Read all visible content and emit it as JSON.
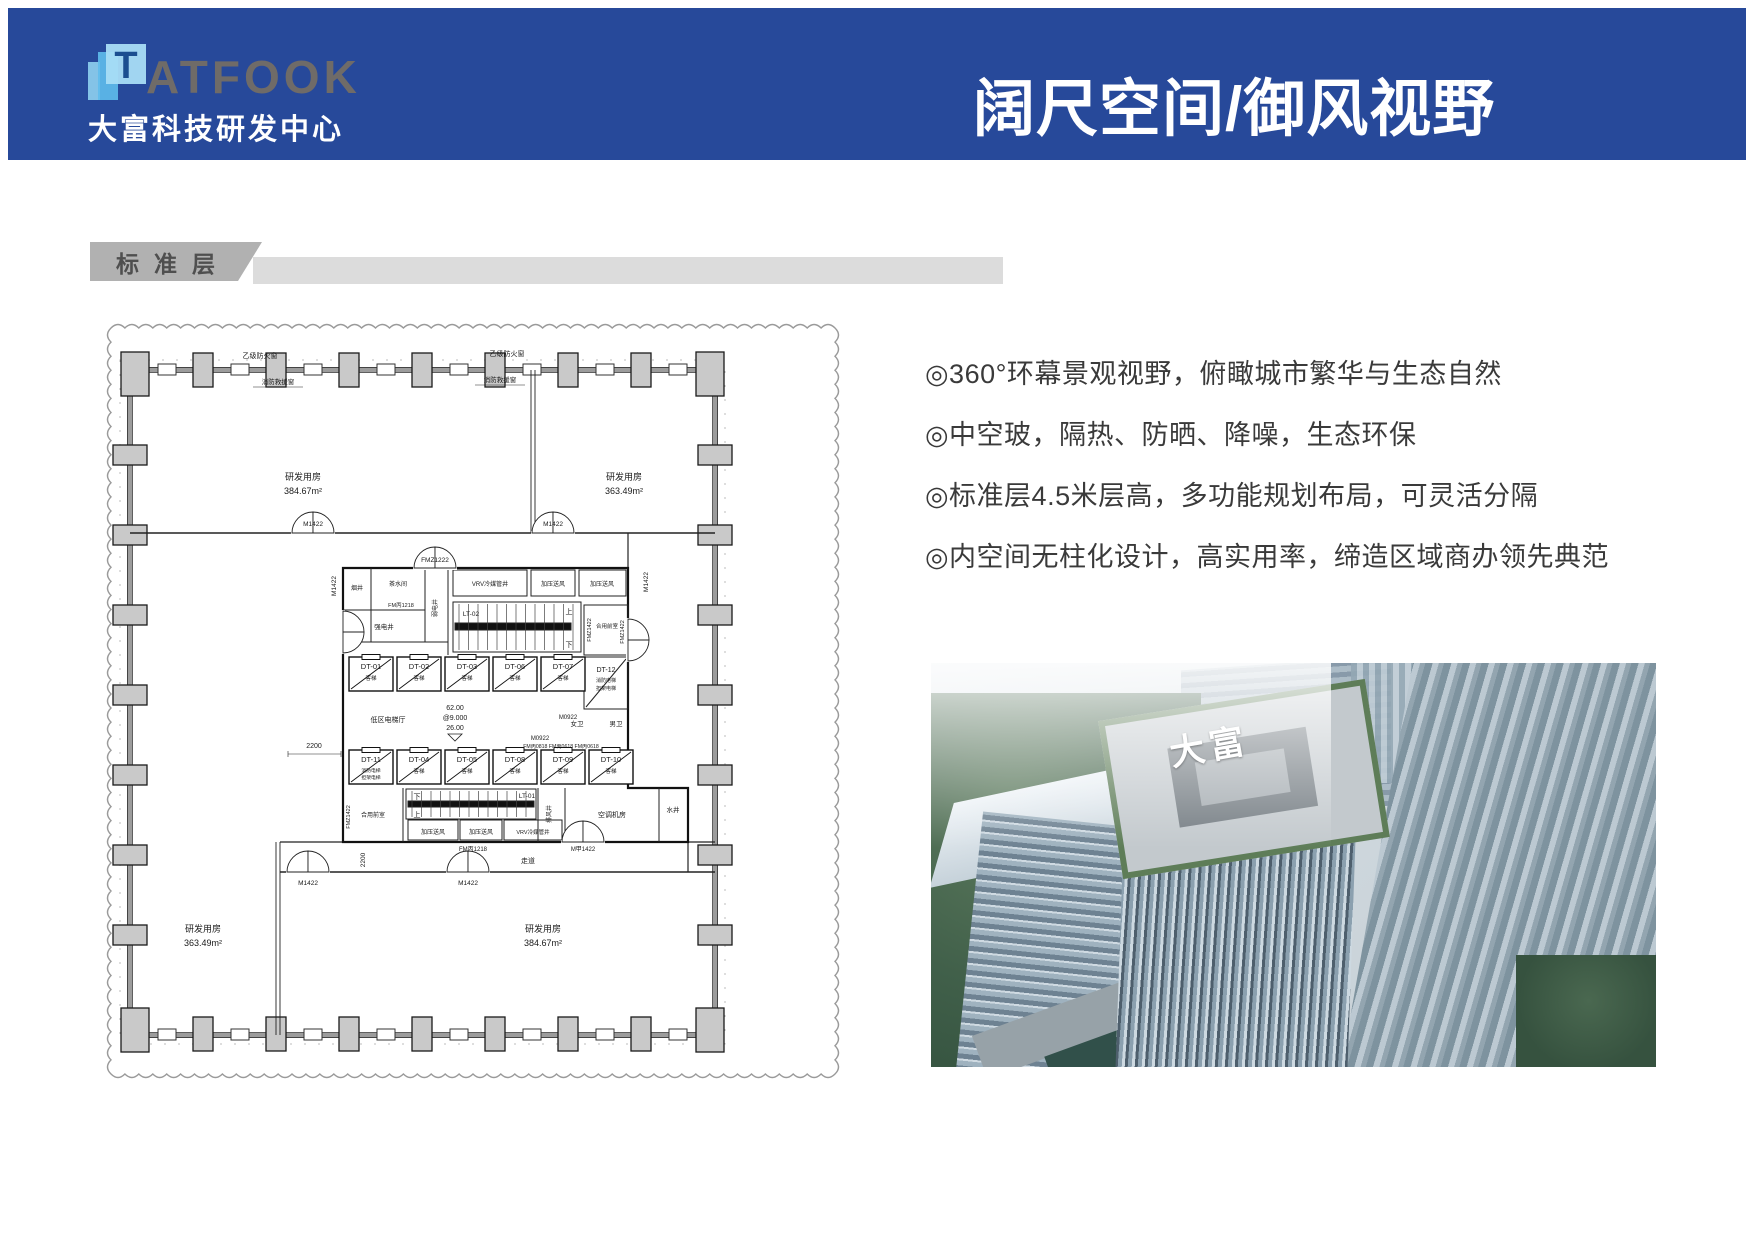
{
  "header": {
    "logo_t": "T",
    "logo_rest": "ATFOOK",
    "logo_subtitle": "大富科技研发中心",
    "title": "阔尺空间/御风视野"
  },
  "section": {
    "label": "标准层"
  },
  "features": [
    "◎360°环幕景观视野，俯瞰城市繁华与生态自然",
    "◎中空玻，隔热、防晒、降噪，生态环保",
    "◎标准层4.5米层高，多功能规划布局，可灵活分隔",
    "◎内空间无柱化设计，高实用率，缔造区域商办领先典范"
  ],
  "plan": {
    "room_name": "研发用房",
    "area_large": "384.67m²",
    "area_small": "363.49m²",
    "fire_window": "乙级防火窗",
    "rescue_window": "消防救援窗",
    "door_m1422": "M1422",
    "door_fmz1222": "FMZ1222",
    "door_fmz1422": "FMZ1422",
    "door_fmb1218": "FM丙1218",
    "door_fmb_row": "FM丙0818 FM丙0618 FM丙0618",
    "door_m0922": "M0922",
    "door_mjia1422": "M甲1422",
    "dim_2200": "2200",
    "corridor": "走道",
    "lobby": "低区电梯厅",
    "lv1": "62.00",
    "lv2": "@9.000",
    "lv3": "26.00",
    "smoke": "烟井",
    "tea": "茶水间",
    "weak": "弱电井",
    "strong": "强电井",
    "vrv": "VRV冷媒管井",
    "press": "加压送风",
    "lobby_shared": "合用前室",
    "wc_f": "女卫",
    "wc_m": "男卫",
    "exhaust": "排风井",
    "ahu": "空调机房",
    "water": "水井",
    "stair1": "LT-01",
    "stair2": "LT-02",
    "up": "上",
    "down": "下",
    "lift_type": "客梯",
    "fire_lift": "消防电梯",
    "stretcher_lift": "担架电梯",
    "lift12": "DT-12",
    "lifts_r1": [
      "DT-01",
      "DT-02",
      "DT-03",
      "DT-06",
      "DT-07"
    ],
    "lifts_r2": [
      "DT-11",
      "DT-04",
      "DT-05",
      "DT-08",
      "DT-09",
      "DT-10"
    ]
  },
  "photo": {
    "tower_sign": "大富"
  },
  "colors": {
    "banner_blue": "#27499A",
    "tab_gray": "#B1B1B1",
    "strip_gray": "#DCDCDC",
    "logo_light_blue": "#A8DDF5",
    "logo_mid_blue": "#5FBCEC",
    "logo_navy": "#1B4E90"
  }
}
